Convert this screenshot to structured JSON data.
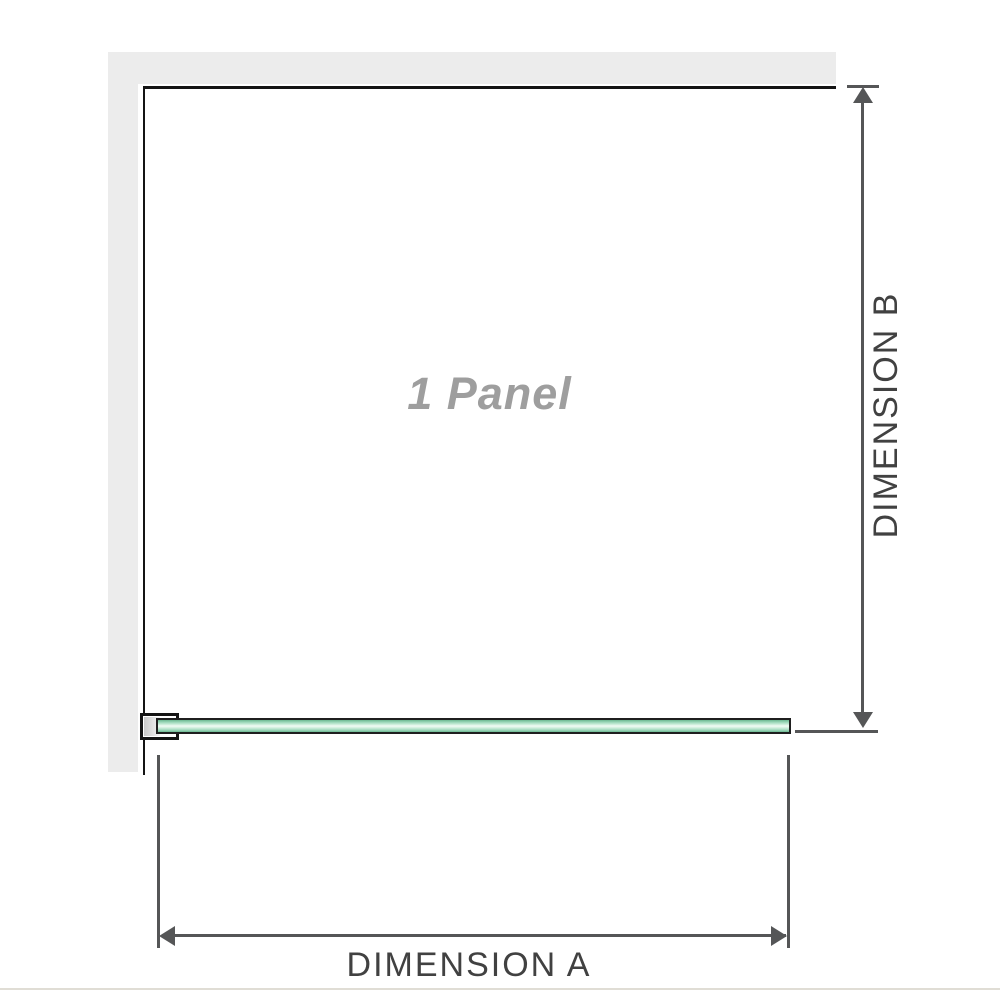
{
  "diagram": {
    "panel_label": "1 Panel",
    "dimension_a_label": "DIMENSION A",
    "dimension_b_label": "DIMENSION B"
  },
  "colors": {
    "wall": "#ececec",
    "outline": "#141414",
    "dimension": "#555657",
    "dim_text": "#414141",
    "label_gray": "#9e9e9e",
    "glass_border": "#1f1f1f",
    "glass_dark": "#6bb891",
    "glass_mid": "#9fd9bc",
    "glass_light": "#f2fbf6",
    "separator": "#e0ddd5"
  }
}
